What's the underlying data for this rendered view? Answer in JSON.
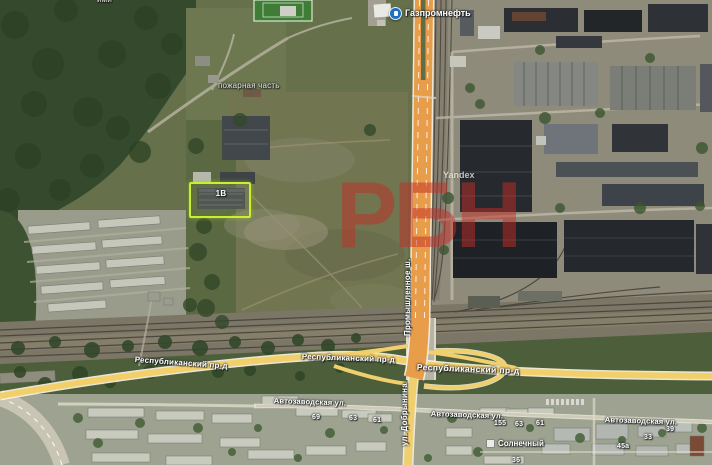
{
  "map": {
    "type": "satellite-hybrid",
    "provider_watermark": "Yandex",
    "overlay_watermark": "РБН",
    "colors": {
      "highlight_outline": "#c9ef35",
      "highway_orange": "#e79d4a",
      "road_yellow": "#f2cf68",
      "watermark_red": "#c32d26"
    }
  },
  "poi": {
    "fuel_station": {
      "label": "Газпромнефть",
      "icon": "fuel-station-icon"
    },
    "fire_station_label": "пожарная часть",
    "district_label": "Солнечный",
    "partial_edge_label": "ими"
  },
  "selected_building": {
    "number": "1В"
  },
  "streets": {
    "promyshlennoye": "Промышленное ш.",
    "dobrynina": "ул. Добрынина",
    "respublikansky": "Республиканский пр-д",
    "avtozavodskaya": "Автозаводская ул."
  },
  "building_numbers": {
    "b69": "69",
    "b63_left": "63",
    "b61_left": "61",
    "b155": "155",
    "b63_right": "63",
    "b61_right": "61",
    "b39": "39",
    "b33": "33",
    "b45a": "45а",
    "b36": "36"
  }
}
